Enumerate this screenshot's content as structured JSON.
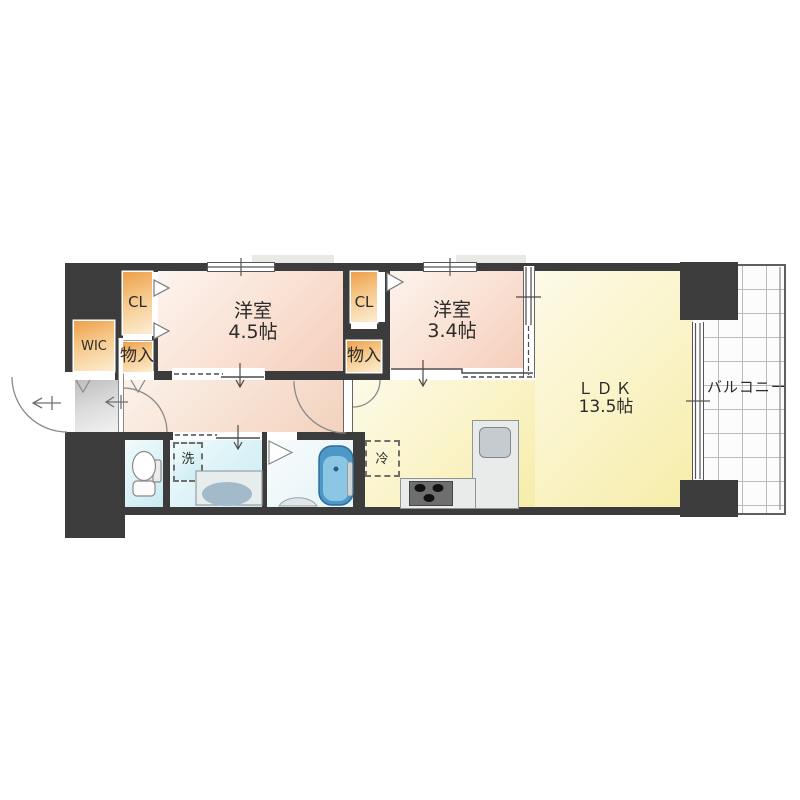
{
  "floorplan": {
    "rooms": {
      "bedroom1": {
        "name": "洋室",
        "size": "4.5帖"
      },
      "bedroom2": {
        "name": "洋室",
        "size": "3.4帖"
      },
      "ldk": {
        "name": "ＬＤＫ",
        "size": "13.5帖"
      },
      "balcony": {
        "name": "バルコニー"
      }
    },
    "storage": {
      "wic": "WIC",
      "closet_left": "CL",
      "closet_right": "CL",
      "storage_left": "物入",
      "storage_right": "物入"
    },
    "appliances": {
      "washer": "洗",
      "fridge": "冷"
    },
    "colors": {
      "wall": "#3c3c3c",
      "bedroom_floor": "#f5cdbb",
      "ldk_floor": "#f6eda8",
      "closet": "#eea04a",
      "wet_area_floor": "#c8ebf2",
      "bathtub": "#4e98c9",
      "entrance_floor": "#c2c2c2",
      "balcony_grid": "#bcbcbc"
    }
  }
}
